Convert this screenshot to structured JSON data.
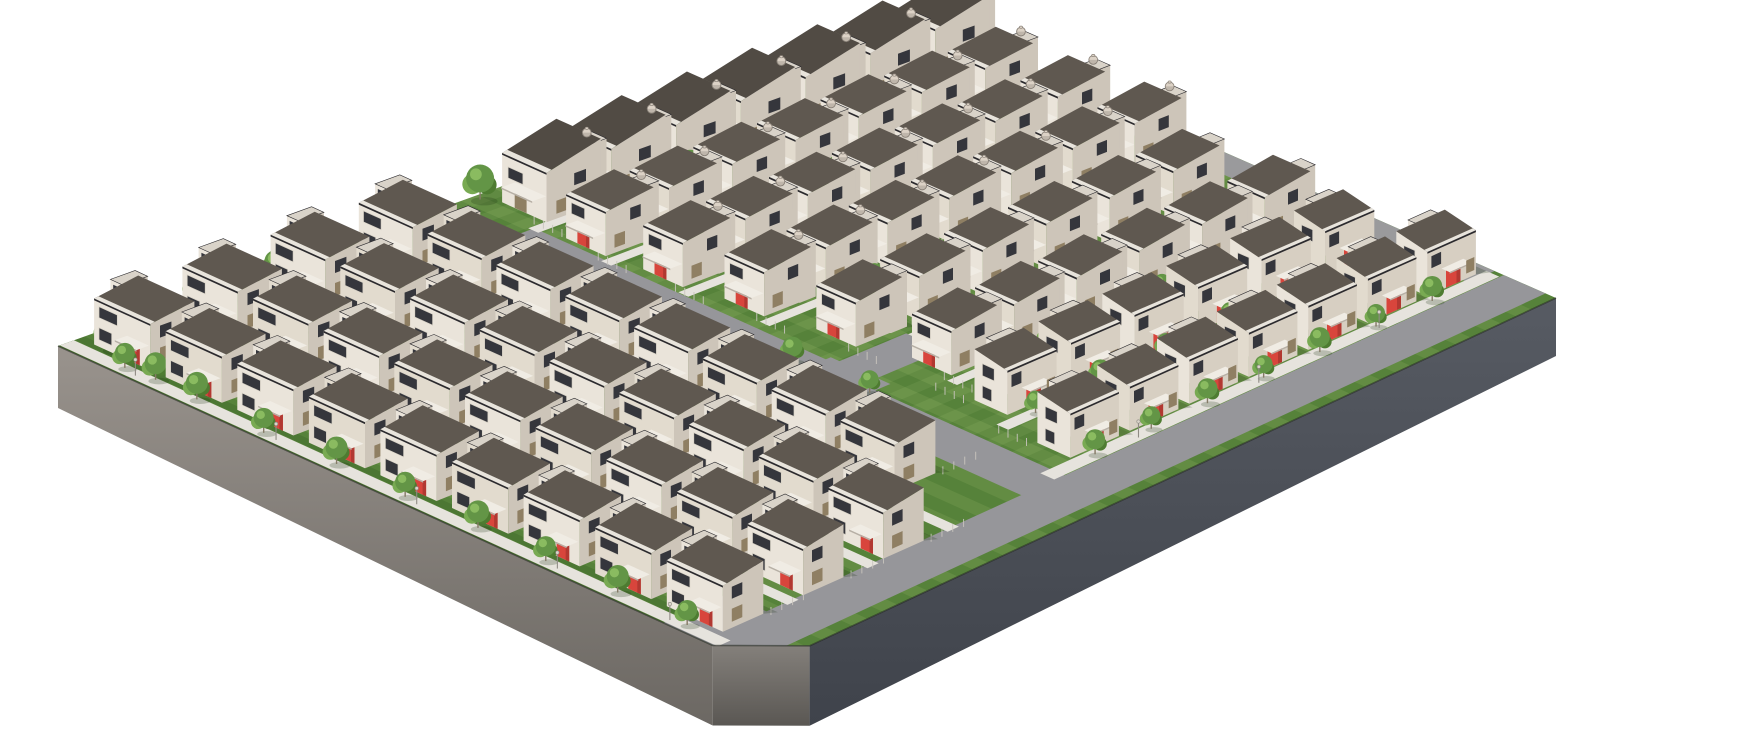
{
  "meta": {
    "kind": "3d-architectural-rendering",
    "subject": "isometric aerial rendering of a suburban tract-housing development on a gray plinth",
    "background": "#ffffff",
    "width": 1762,
    "height": 730
  },
  "palette": {
    "grass": "#56823a",
    "grass_stripe_light": "rgba(215,235,150,0.10)",
    "grass_stripe_light2": "rgba(220,240,160,0.08)",
    "grass_edge_dark": "rgba(10,40,5,0.12)",
    "road": "#96969a",
    "road2": "#9a9a9c",
    "path": "#e6e3dd",
    "wall_light": "#eae4da",
    "wall_light_alt": "#e2dbce",
    "wall_mid": "#cdc5b9",
    "wall_front_edge": "#d7cfc2",
    "tower_top": "#d9d3c9",
    "roof": "#5f5850",
    "roof_dark": "#514b44",
    "parapet": "#e8e4dc",
    "eave": "#2b2a2e",
    "door_red": "#d8453c",
    "door_red_dark": "#b23831",
    "door_tan": "#9a8а6a",
    "canopy": "#f0ece4",
    "canopy_edge": "#b7b0a6",
    "win_dark": "#35363c",
    "win_tan": "#8f7f63",
    "win_frame": "#d8d2c6",
    "trunk": "#857a66",
    "tree_main": "#639546",
    "tree_dark": "#4e7c31",
    "tree_light": "#78aa52",
    "tree_hi": "#8abb60",
    "post": "#c9c5be",
    "lamp_pole": "#8f8b84",
    "lamp_head": "#dad5ca",
    "shadow": "rgba(25,45,15,0.22)",
    "tinaco": "#dcd2c6",
    "tinaco_line": "#8c847b",
    "plinth_left_top": "#99938d",
    "plinth_left_bot": "#6c6863",
    "plinth_bevel_top": "#84807b",
    "plinth_bevel_bot": "#5a5753",
    "plinth_right_top": "#575b63",
    "plinth_right_bot": "#3f434b",
    "plinth_edge_line": "rgba(30,32,28,0.55)"
  },
  "site": {
    "corners": {
      "left": [
        58,
        346
      ],
      "top": [
        942,
        28
      ],
      "right": [
        1556,
        298
      ],
      "bottom": [
        762,
        668
      ]
    },
    "bevel": {
      "u": 93,
      "v": 6
    },
    "plinth": {
      "depth_left": 62,
      "depth_bevel": 80,
      "depth_right": 58
    }
  },
  "ground_stripes": {
    "count_u": 26,
    "step": 3.8,
    "band": 1.9
  },
  "roads": [
    {
      "name": "perimeter-road-right",
      "rect": [
        91.5,
        2,
        98.3,
        100
      ],
      "color": "road"
    },
    {
      "name": "corner-road-bevel",
      "rect": [
        86,
        0,
        98.3,
        8
      ],
      "color": "road"
    },
    {
      "name": "main-road-east",
      "rect": [
        56,
        39.8,
        92.5,
        45.2
      ],
      "color": "road"
    },
    {
      "name": "main-road-west",
      "rect": [
        10,
        41,
        58,
        46.4
      ],
      "color": "road"
    },
    {
      "name": "junction",
      "rect": [
        54,
        39.5,
        63,
        47
      ],
      "color": "road"
    },
    {
      "name": "road-north-spur",
      "rect": [
        55.3,
        46,
        61,
        55
      ],
      "color": "road"
    },
    {
      "name": "road-top-edge",
      "rect": [
        6,
        96.8,
        90,
        100
      ],
      "color": "road2"
    }
  ],
  "paths": [
    {
      "name": "walk-bottom-left",
      "rect": [
        0,
        0.2,
        93.5,
        1.8
      ]
    },
    {
      "name": "walk-row-2",
      "rect": [
        1,
        10.2,
        92,
        11.6
      ]
    },
    {
      "name": "walk-row-3",
      "rect": [
        1,
        20.2,
        92,
        21.6
      ]
    },
    {
      "name": "walk-row-4",
      "rect": [
        1,
        30.2,
        92,
        31.6
      ]
    },
    {
      "name": "walk-g0",
      "rect": [
        9.6,
        46,
        11.1,
        98
      ]
    },
    {
      "name": "walk-r5",
      "rect": [
        20.6,
        46,
        22.1,
        98
      ]
    },
    {
      "name": "walk-r6",
      "rect": [
        31.6,
        46.5,
        33.1,
        98
      ]
    },
    {
      "name": "walk-r7",
      "rect": [
        42.6,
        47.5,
        44.1,
        98
      ]
    },
    {
      "name": "walk-spur",
      "rect": [
        55.6,
        55,
        57.2,
        98
      ]
    },
    {
      "name": "walk-r9",
      "rect": [
        66.6,
        51,
        68.1,
        98
      ]
    },
    {
      "name": "walk-e1",
      "rect": [
        77.8,
        48,
        79.6,
        99
      ]
    },
    {
      "name": "walk-e2",
      "rect": [
        89.3,
        44,
        91.4,
        99.5
      ]
    }
  ],
  "house_rows": [
    {
      "id": "L1",
      "orient": "u",
      "fixed": 2.5,
      "start": 2,
      "pitch": 10.2,
      "count": 9,
      "door": "-v",
      "tinaco": false,
      "scale": 1
    },
    {
      "id": "L2",
      "orient": "u",
      "fixed": 12.5,
      "start": 2,
      "pitch": 10.2,
      "count": 9,
      "door": "-v",
      "tinaco": false,
      "scale": 1
    },
    {
      "id": "L3",
      "orient": "u",
      "fixed": 22.5,
      "start": 2,
      "pitch": 10.2,
      "count": 9,
      "door": "-v",
      "tinaco": false,
      "scale": 1
    },
    {
      "id": "L4",
      "orient": "u",
      "fixed": 32.5,
      "start": 2,
      "pitch": 10.2,
      "count": 8,
      "door": "-v",
      "tinaco": false,
      "scale": 1
    },
    {
      "id": "G0",
      "orient": "v",
      "fixed": 3,
      "start": 48,
      "pitch": 7.4,
      "count": 7,
      "door": "none",
      "tinaco": true,
      "scale": 1.12,
      "gable": true
    },
    {
      "id": "R5",
      "orient": "v",
      "fixed": 14,
      "start": 47,
      "pitch": 7.3,
      "count": 7,
      "door": "-v",
      "tinaco": true,
      "scale": 1
    },
    {
      "id": "R6",
      "orient": "v",
      "fixed": 25,
      "start": 47.5,
      "pitch": 7.3,
      "count": 7,
      "door": "-v",
      "tinaco": true,
      "scale": 1
    },
    {
      "id": "R7",
      "orient": "v",
      "fixed": 36,
      "start": 48.5,
      "pitch": 7.3,
      "count": 7,
      "door": "-v",
      "tinaco": true,
      "scale": 1
    },
    {
      "id": "R8",
      "orient": "v",
      "fixed": 48,
      "start": 50,
      "pitch": 7.6,
      "count": 6,
      "door": "-v",
      "tinaco": false,
      "scale": 1
    },
    {
      "id": "R9",
      "orient": "v",
      "fixed": 60,
      "start": 52,
      "pitch": 7.6,
      "count": 6,
      "door": "-v",
      "tinaco": false,
      "scale": 1
    },
    {
      "id": "E1",
      "orient": "e",
      "fixed": 72,
      "start": 50,
      "pitch": 7.8,
      "count": 6,
      "door": "+u",
      "tinaco": false,
      "scale": 1
    },
    {
      "id": "E2",
      "orient": "e",
      "fixed": 84,
      "start": 48,
      "pitch": 7.4,
      "count": 7,
      "door": "+u",
      "tinaco": false,
      "scale": 1
    }
  ],
  "house_dims": {
    "u_row": {
      "w": 8,
      "d": 5,
      "h_main": 46,
      "roof_rise": 7,
      "h_tower": 58,
      "h_canopy": 21
    },
    "v_row": {
      "w": 6,
      "d": 5.5,
      "h_main": 44,
      "roof_rise": 7,
      "h_tower": 56,
      "h_canopy": 20
    },
    "gable": {
      "roof_rise": 13
    },
    "edge": {
      "w": 6,
      "d": 5,
      "h_main": 44,
      "roof_rise": 7,
      "h_tower": 56,
      "h_canopy": 20
    }
  },
  "trees": [
    [
      1.5,
      7,
      13
    ],
    [
      0.8,
      15,
      11
    ],
    [
      2.2,
      23,
      12
    ],
    [
      1.2,
      31,
      10
    ],
    [
      2.0,
      39,
      12
    ],
    [
      1.0,
      47,
      14
    ],
    [
      2.5,
      54,
      11
    ],
    [
      4,
      3,
      15
    ],
    [
      12,
      1.5,
      11
    ],
    [
      8,
      1.2,
      10
    ],
    [
      18,
      1.4,
      11
    ],
    [
      28,
      1.0,
      10
    ],
    [
      38,
      1.3,
      11
    ],
    [
      48,
      1.1,
      10
    ],
    [
      58,
      1.4,
      11
    ],
    [
      68,
      1.1,
      10
    ],
    [
      78,
      1.3,
      11
    ],
    [
      88,
      1.2,
      10
    ],
    [
      16,
      9.9,
      9
    ],
    [
      37,
      9.9,
      10
    ],
    [
      58,
      9.9,
      9
    ],
    [
      79,
      9.9,
      10
    ],
    [
      16,
      19.9,
      10
    ],
    [
      37,
      19.9,
      9
    ],
    [
      58,
      19.9,
      10
    ],
    [
      79,
      19.9,
      9
    ],
    [
      20,
      29.9,
      9
    ],
    [
      41,
      29.9,
      10
    ],
    [
      62,
      29.9,
      9
    ],
    [
      52,
      44,
      10
    ],
    [
      63,
      44.5,
      9
    ],
    [
      47,
      42,
      8
    ],
    [
      10.3,
      64,
      9
    ],
    [
      10.3,
      80,
      9
    ],
    [
      22.3,
      58,
      9
    ],
    [
      22.3,
      72,
      10
    ],
    [
      22.3,
      86,
      9
    ],
    [
      33,
      62,
      9
    ],
    [
      33,
      78,
      9
    ],
    [
      33,
      90,
      8
    ],
    [
      44,
      60,
      8
    ],
    [
      44,
      74,
      9
    ],
    [
      44,
      88,
      8
    ],
    [
      56,
      66,
      9
    ],
    [
      56,
      82,
      8
    ],
    [
      68,
      62,
      8
    ],
    [
      68,
      76,
      9
    ],
    [
      68,
      90,
      8
    ],
    [
      78.8,
      52,
      9
    ],
    [
      78.8,
      60,
      10
    ],
    [
      78.8,
      68,
      9
    ],
    [
      78.8,
      76,
      10
    ],
    [
      78.8,
      84,
      9
    ],
    [
      78.8,
      92,
      10
    ],
    [
      90.3,
      50,
      10
    ],
    [
      90.3,
      57,
      9
    ],
    [
      90.3,
      64,
      10
    ],
    [
      90.3,
      71,
      9
    ],
    [
      90.3,
      78,
      10
    ],
    [
      90.3,
      85,
      9
    ],
    [
      90.3,
      92,
      10
    ],
    [
      14,
      98.5,
      9
    ],
    [
      24,
      98.5,
      10
    ]
  ],
  "lamps": [
    [
      10,
      0.8
    ],
    [
      30,
      0.8
    ],
    [
      50,
      0.8
    ],
    [
      70,
      0.8
    ],
    [
      86,
      0.8
    ],
    [
      90.8,
      55
    ],
    [
      90.8,
      70
    ],
    [
      90.8,
      85
    ],
    [
      22,
      41.8
    ],
    [
      40,
      41.8
    ],
    [
      70,
      39.5
    ]
  ],
  "counts": {
    "houses": 88,
    "trees": 63,
    "lamps": 11
  }
}
